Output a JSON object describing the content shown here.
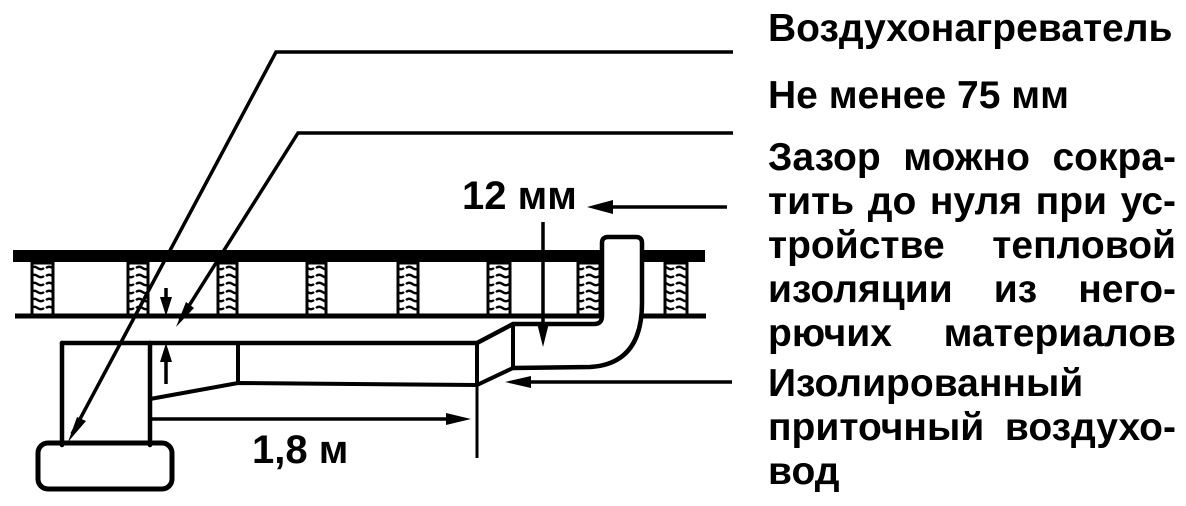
{
  "colors": {
    "ink": "#000000",
    "paper": "#ffffff"
  },
  "diagram_dimensions": {
    "floor_gap": "12 мм",
    "duct_length": "1,8 м"
  },
  "labels": {
    "air_heater": "Воздухонагреватель",
    "min_gap": "Не менее 75 мм",
    "gap_note": [
      "Зазор можно сокра-",
      "тить до нуля при ус-",
      "тройстве тепловой",
      "изоляции из него-",
      "рючих материалов"
    ],
    "insulated_duct": [
      "Изолированный",
      "приточный воздухо-",
      "вод"
    ]
  }
}
